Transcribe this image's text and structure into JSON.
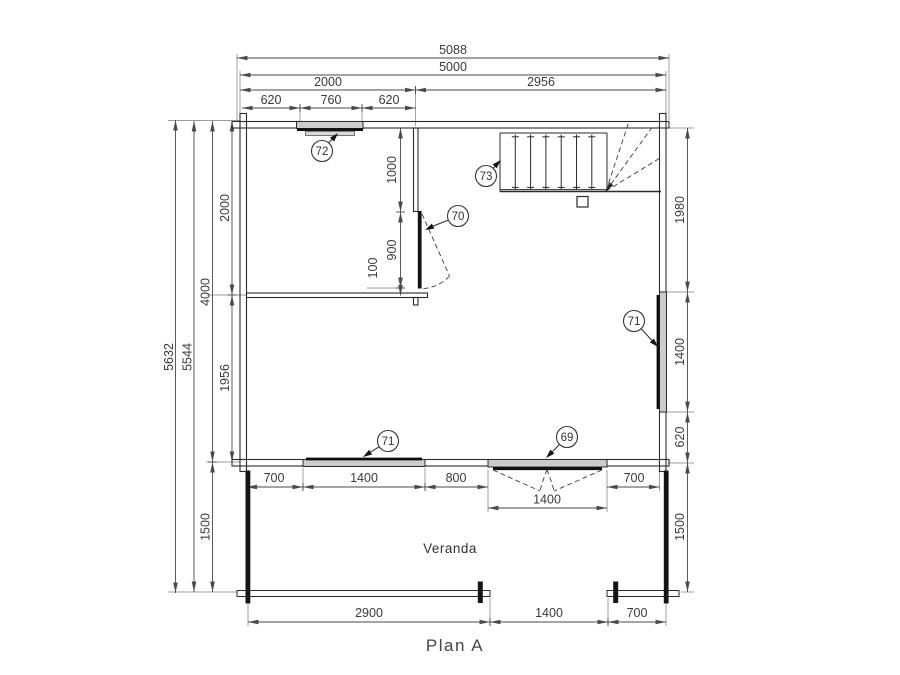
{
  "title": "Plan A",
  "labels": {
    "veranda": "Veranda"
  },
  "dims": {
    "top": [
      "5088",
      "5000",
      "2000",
      "2956",
      "620",
      "760",
      "620"
    ],
    "left": [
      "5632",
      "5544",
      "2000",
      "4000",
      "1956",
      "1500"
    ],
    "right": [
      "1980",
      "1400",
      "620",
      "1500"
    ],
    "door70_offsets": [
      "1000",
      "900",
      "100"
    ],
    "bottom_wall": [
      "700",
      "1400",
      "800",
      "1400",
      "700"
    ],
    "veranda_bottom": [
      "2900",
      "1400",
      "700"
    ]
  },
  "callouts": {
    "window_top": "72",
    "staircase": "73",
    "door_interior": "70",
    "window_right": "71",
    "window_bottom": "71",
    "door_veranda": "69"
  },
  "colors": {
    "wall_line": "#2b2b2b",
    "dim_line": "#4a4a4a",
    "window_fill": "#cccccc",
    "door_leaf": "#141414",
    "text": "#3a3a3a"
  }
}
